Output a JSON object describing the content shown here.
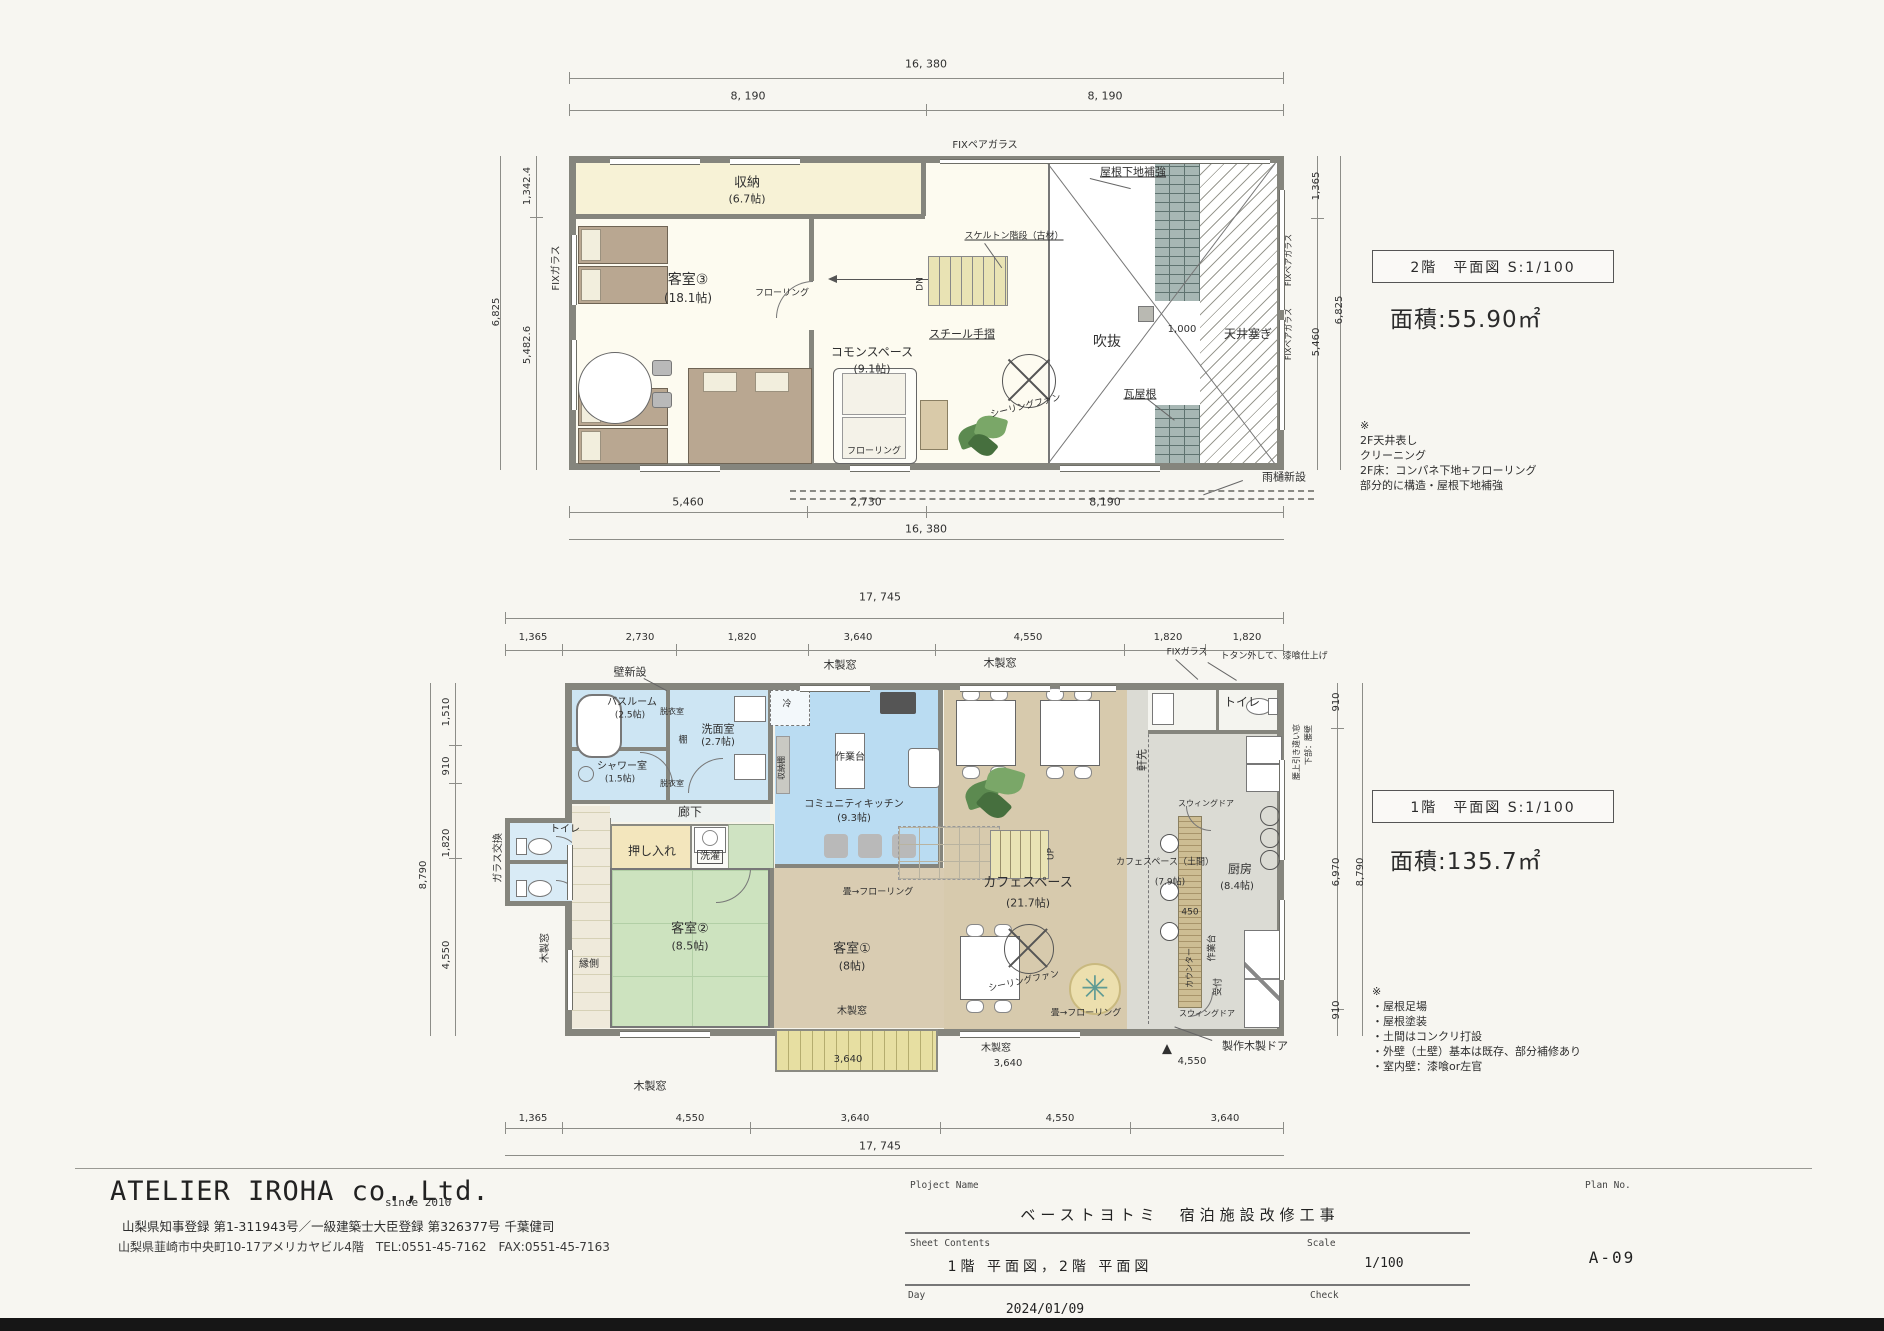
{
  "company": {
    "name": "ATELIER IROHA co.,Ltd.",
    "since": "since 2010",
    "registration": "山梨県知事登録 第1-311943号／一級建築士大臣登録 第326377号 千葉健司",
    "address": "山梨県韮崎市中央町10-17アメリカヤビル4階　TEL:0551-45-7162　FAX:0551-45-7163"
  },
  "titleblock": {
    "project_label": "Ploject Name",
    "project_name": "ベーストヨトミ　宿泊施設改修工事",
    "sheet_label": "Sheet Contents",
    "sheet_contents": "1階 平面図，2階 平面図",
    "scale_label": "Scale",
    "scale": "1/100",
    "day_label": "Day",
    "day": "2024/01/09",
    "check_label": "Check",
    "plan_no_label": "Plan No.",
    "plan_no": "A-09"
  },
  "floor2": {
    "title": "2階　平面図 S:1/100",
    "area": "面積:55.90㎡",
    "notes": [
      "※",
      "2F天井表し",
      "クリーニング",
      "2F床：コンパネ下地+フローリング",
      "部分的に構造・屋根下地補強"
    ],
    "labels": [
      {
        "t": "16, 380",
        "x": 926,
        "y": 64,
        "fs": 11,
        "n": "dim-overall-width-2f"
      },
      {
        "t": "8, 190",
        "x": 748,
        "y": 96,
        "fs": 11,
        "n": "dim"
      },
      {
        "t": "8, 190",
        "x": 1105,
        "y": 96,
        "fs": 11,
        "n": "dim"
      },
      {
        "t": "FIXペアガラス",
        "x": 985,
        "y": 146,
        "fs": 10,
        "n": "fix-pair-glass-label"
      },
      {
        "t": "1,342.4",
        "x": 528,
        "y": 186,
        "fs": 10,
        "r": -90,
        "n": "dim"
      },
      {
        "t": "5,482.6",
        "x": 528,
        "y": 345,
        "fs": 10,
        "r": -90,
        "n": "dim"
      },
      {
        "t": "6,825",
        "x": 497,
        "y": 312,
        "fs": 10,
        "r": -90,
        "n": "dim"
      },
      {
        "t": "FIXガラス",
        "x": 557,
        "y": 268,
        "fs": 10,
        "r": -90,
        "n": "fix-glass-label"
      },
      {
        "t": "収納",
        "x": 747,
        "y": 183,
        "fs": 13,
        "n": "room-label-storage"
      },
      {
        "t": "(6.7帖)",
        "x": 747,
        "y": 199,
        "fs": 11,
        "n": "room-size"
      },
      {
        "t": "客室③",
        "x": 688,
        "y": 280,
        "fs": 14,
        "n": "room-label-guestroom3"
      },
      {
        "t": "(18.1帖)",
        "x": 688,
        "y": 298,
        "fs": 12,
        "n": "room-size"
      },
      {
        "t": "フローリング",
        "x": 782,
        "y": 294,
        "fs": 9,
        "n": "flooring-note"
      },
      {
        "t": "コモンスペース",
        "x": 872,
        "y": 352,
        "fs": 12,
        "n": "room-label-common-space"
      },
      {
        "t": "(9.1帖)",
        "x": 872,
        "y": 369,
        "fs": 11,
        "n": "room-size"
      },
      {
        "t": "フローリング",
        "x": 874,
        "y": 452,
        "fs": 9,
        "n": "flooring-note"
      },
      {
        "t": "スケルトン階段（古材）",
        "x": 1014,
        "y": 237,
        "fs": 9,
        "ul": true,
        "n": "stair-note"
      },
      {
        "t": "DN",
        "x": 921,
        "y": 284,
        "fs": 9,
        "r": -90,
        "n": "stair-down-label"
      },
      {
        "t": "スチール手摺",
        "x": 962,
        "y": 334,
        "fs": 11,
        "ul": true,
        "n": "steel-handrail-label"
      },
      {
        "t": "吹抜",
        "x": 1107,
        "y": 342,
        "fs": 14,
        "n": "void-label"
      },
      {
        "t": "シーリングファン",
        "x": 1026,
        "y": 407,
        "fs": 9,
        "r": -14,
        "n": "ceiling-fan-label"
      },
      {
        "t": "瓦屋根",
        "x": 1140,
        "y": 394,
        "fs": 11,
        "ul": true,
        "n": "tile-roof-label"
      },
      {
        "t": "屋根下地補強",
        "x": 1133,
        "y": 172,
        "fs": 11,
        "ul": true,
        "n": "roof-reinforce-label"
      },
      {
        "t": "1,000",
        "x": 1182,
        "y": 330,
        "fs": 10,
        "n": "dim"
      },
      {
        "t": "天井塞ぎ",
        "x": 1248,
        "y": 334,
        "fs": 12,
        "n": "ceiling-close-label"
      },
      {
        "t": "FIXペアガラス",
        "x": 1289,
        "y": 260,
        "fs": 8,
        "r": -90,
        "n": "fix-pair-glass-label"
      },
      {
        "t": "FIXペアガラス",
        "x": 1289,
        "y": 334,
        "fs": 8,
        "r": -90,
        "n": "fix-pair-glass-label"
      },
      {
        "t": "1,365",
        "x": 1317,
        "y": 186,
        "fs": 10,
        "r": -90,
        "n": "dim"
      },
      {
        "t": "5,460",
        "x": 1317,
        "y": 342,
        "fs": 10,
        "r": -90,
        "n": "dim"
      },
      {
        "t": "6,825",
        "x": 1340,
        "y": 310,
        "fs": 10,
        "r": -90,
        "n": "dim"
      },
      {
        "t": "5,460",
        "x": 688,
        "y": 502,
        "fs": 11,
        "n": "dim"
      },
      {
        "t": "2,730",
        "x": 866,
        "y": 502,
        "fs": 11,
        "n": "dim"
      },
      {
        "t": "8,190",
        "x": 1105,
        "y": 502,
        "fs": 11,
        "n": "dim"
      },
      {
        "t": "16, 380",
        "x": 926,
        "y": 529,
        "fs": 11,
        "n": "dim"
      },
      {
        "t": "雨樋新設",
        "x": 1284,
        "y": 477,
        "fs": 11,
        "n": "rain-gutter-label"
      }
    ]
  },
  "floor1": {
    "title": "1階　平面図 S:1/100",
    "area": "面積:135.7㎡",
    "notes": [
      "※",
      "・屋根足場",
      "・屋根塗装",
      "・土間はコンクリ打設",
      "・外壁（土壁）基本は既存、部分補修あり",
      "・室内壁：漆喰or左官"
    ],
    "labels": [
      {
        "t": "17, 745",
        "x": 880,
        "y": 597,
        "fs": 11,
        "n": "dim-overall-width-1f"
      },
      {
        "t": "1,365",
        "x": 533,
        "y": 638,
        "fs": 10,
        "n": "dim"
      },
      {
        "t": "2,730",
        "x": 640,
        "y": 638,
        "fs": 10,
        "n": "dim"
      },
      {
        "t": "1,820",
        "x": 742,
        "y": 638,
        "fs": 10,
        "n": "dim"
      },
      {
        "t": "3,640",
        "x": 858,
        "y": 638,
        "fs": 10,
        "n": "dim"
      },
      {
        "t": "4,550",
        "x": 1028,
        "y": 638,
        "fs": 10,
        "n": "dim"
      },
      {
        "t": "1,820",
        "x": 1168,
        "y": 638,
        "fs": 10,
        "n": "dim"
      },
      {
        "t": "1,820",
        "x": 1247,
        "y": 638,
        "fs": 10,
        "n": "dim"
      },
      {
        "t": "壁新設",
        "x": 630,
        "y": 672,
        "fs": 11,
        "n": "new-wall-label"
      },
      {
        "t": "木製窓",
        "x": 840,
        "y": 665,
        "fs": 11,
        "n": "wood-window-label"
      },
      {
        "t": "木製窓",
        "x": 1000,
        "y": 663,
        "fs": 11,
        "n": "wood-window-label"
      },
      {
        "t": "FIXガラス",
        "x": 1187,
        "y": 653,
        "fs": 9,
        "n": "fix-glass-label"
      },
      {
        "t": "トタン外して、漆喰仕上げ",
        "x": 1274,
        "y": 657,
        "fs": 9,
        "n": "plaster-finish-note"
      },
      {
        "t": "トイレ",
        "x": 1242,
        "y": 702,
        "fs": 12,
        "n": "room-label-toilet"
      },
      {
        "t": "バスルーム",
        "x": 632,
        "y": 703,
        "fs": 10,
        "n": "room-label-bathroom"
      },
      {
        "t": "(2.5帖)",
        "x": 630,
        "y": 716,
        "fs": 9,
        "n": "room-size"
      },
      {
        "t": "脱衣室",
        "x": 672,
        "y": 712,
        "fs": 8,
        "n": "room-label-dressing"
      },
      {
        "t": "洗面室",
        "x": 718,
        "y": 729,
        "fs": 11,
        "n": "room-label-washroom"
      },
      {
        "t": "(2.7帖)",
        "x": 718,
        "y": 743,
        "fs": 10,
        "n": "room-size"
      },
      {
        "t": "棚",
        "x": 683,
        "y": 741,
        "fs": 9,
        "n": "shelf-label"
      },
      {
        "t": "シャワー室",
        "x": 622,
        "y": 767,
        "fs": 10,
        "n": "room-label-shower"
      },
      {
        "t": "(1.5帖)",
        "x": 620,
        "y": 780,
        "fs": 9,
        "n": "room-size"
      },
      {
        "t": "脱衣室",
        "x": 672,
        "y": 784,
        "fs": 8,
        "n": "room-label-dressing"
      },
      {
        "t": "冷",
        "x": 787,
        "y": 705,
        "fs": 9,
        "n": "fridge-label"
      },
      {
        "t": "作業台",
        "x": 850,
        "y": 758,
        "fs": 10,
        "n": "worktable-label"
      },
      {
        "t": "コミュニティキッチン",
        "x": 854,
        "y": 805,
        "fs": 10,
        "n": "room-label-community-kitchen"
      },
      {
        "t": "(9.3帖)",
        "x": 854,
        "y": 819,
        "fs": 10,
        "n": "room-size"
      },
      {
        "t": "収納棚",
        "x": 782,
        "y": 768,
        "fs": 8,
        "r": -90,
        "n": "storage-shelf-label"
      },
      {
        "t": "廊下",
        "x": 690,
        "y": 812,
        "fs": 12,
        "n": "room-label-corridor"
      },
      {
        "t": "ガラス交換",
        "x": 499,
        "y": 858,
        "fs": 10,
        "r": -90,
        "n": "glass-replace-label"
      },
      {
        "t": "トイレ",
        "x": 565,
        "y": 830,
        "fs": 10,
        "n": "room-label-toilet"
      },
      {
        "t": "押し入れ",
        "x": 652,
        "y": 851,
        "fs": 12,
        "n": "room-label-closet"
      },
      {
        "t": "洗濯",
        "x": 710,
        "y": 857,
        "fs": 10,
        "box": true,
        "n": "laundry-label"
      },
      {
        "t": "客室②",
        "x": 690,
        "y": 929,
        "fs": 13,
        "n": "room-label-guestroom2"
      },
      {
        "t": "(8.5帖)",
        "x": 690,
        "y": 946,
        "fs": 11,
        "n": "room-size"
      },
      {
        "t": "縁側",
        "x": 589,
        "y": 965,
        "fs": 10,
        "n": "room-label-engawa"
      },
      {
        "t": "木製窓",
        "x": 546,
        "y": 948,
        "fs": 10,
        "r": -90,
        "n": "wood-window-label"
      },
      {
        "t": "客室①",
        "x": 852,
        "y": 949,
        "fs": 13,
        "n": "room-label-guestroom1"
      },
      {
        "t": "(8帖)",
        "x": 852,
        "y": 966,
        "fs": 11,
        "n": "room-size"
      },
      {
        "t": "畳→フローリング",
        "x": 878,
        "y": 893,
        "fs": 9,
        "n": "tatami-to-flooring-note"
      },
      {
        "t": "木製窓",
        "x": 852,
        "y": 1012,
        "fs": 10,
        "n": "wood-window-label"
      },
      {
        "t": "カフェスペース",
        "x": 1028,
        "y": 883,
        "fs": 13,
        "n": "room-label-cafe-space"
      },
      {
        "t": "(21.7帖)",
        "x": 1028,
        "y": 903,
        "fs": 11,
        "n": "room-size"
      },
      {
        "t": "シーリングファン",
        "x": 1024,
        "y": 982,
        "fs": 9,
        "r": -12,
        "n": "ceiling-fan-label"
      },
      {
        "t": "畳→フローリング",
        "x": 1086,
        "y": 1014,
        "fs": 9,
        "n": "tatami-to-flooring-note"
      },
      {
        "t": "UP",
        "x": 1052,
        "y": 854,
        "fs": 9,
        "r": -90,
        "n": "stair-up-label"
      },
      {
        "t": "軒先",
        "x": 1142,
        "y": 760,
        "fs": 11,
        "r": -90,
        "n": "eave-label"
      },
      {
        "t": "カフェスペース（土間）",
        "x": 1165,
        "y": 863,
        "fs": 9,
        "n": "room-label-cafe-doma"
      },
      {
        "t": "(7.9帖)",
        "x": 1170,
        "y": 883,
        "fs": 9,
        "n": "room-size"
      },
      {
        "t": "450",
        "x": 1190,
        "y": 913,
        "fs": 9,
        "n": "dim"
      },
      {
        "t": "カウンター",
        "x": 1190,
        "y": 968,
        "fs": 8,
        "r": -90,
        "n": "counter-label"
      },
      {
        "t": "作業台",
        "x": 1213,
        "y": 948,
        "fs": 9,
        "r": -90,
        "n": "worktable-label"
      },
      {
        "t": "受付",
        "x": 1219,
        "y": 987,
        "fs": 9,
        "r": -90,
        "n": "reception-label"
      },
      {
        "t": "スウィングドア",
        "x": 1206,
        "y": 804,
        "fs": 8,
        "n": "swing-door-label"
      },
      {
        "t": "スウィングドア",
        "x": 1207,
        "y": 1014,
        "fs": 8,
        "n": "swing-door-label"
      },
      {
        "t": "厨房",
        "x": 1240,
        "y": 869,
        "fs": 12,
        "n": "room-label-kitchen"
      },
      {
        "t": "(8.4帖)",
        "x": 1237,
        "y": 887,
        "fs": 10,
        "n": "room-size"
      },
      {
        "t": "腰上引き違い窓",
        "x": 1297,
        "y": 752,
        "fs": 8,
        "r": -90,
        "n": "window-note"
      },
      {
        "t": "下部：腰壁",
        "x": 1309,
        "y": 745,
        "fs": 8,
        "r": -90,
        "n": "window-note"
      },
      {
        "t": "910",
        "x": 1337,
        "y": 702,
        "fs": 10,
        "r": -90,
        "n": "dim"
      },
      {
        "t": "6,970",
        "x": 1337,
        "y": 872,
        "fs": 10,
        "r": -90,
        "n": "dim"
      },
      {
        "t": "910",
        "x": 1337,
        "y": 1010,
        "fs": 10,
        "r": -90,
        "n": "dim"
      },
      {
        "t": "8,790",
        "x": 1361,
        "y": 872,
        "fs": 10,
        "r": -90,
        "n": "dim"
      },
      {
        "t": "1,510",
        "x": 447,
        "y": 712,
        "fs": 10,
        "r": -90,
        "n": "dim"
      },
      {
        "t": "910",
        "x": 447,
        "y": 766,
        "fs": 10,
        "r": -90,
        "n": "dim"
      },
      {
        "t": "1,820",
        "x": 447,
        "y": 843,
        "fs": 10,
        "r": -90,
        "n": "dim"
      },
      {
        "t": "4,550",
        "x": 447,
        "y": 955,
        "fs": 10,
        "r": -90,
        "n": "dim"
      },
      {
        "t": "8,790",
        "x": 424,
        "y": 875,
        "fs": 10,
        "r": -90,
        "n": "dim"
      },
      {
        "t": "木製窓",
        "x": 650,
        "y": 1086,
        "fs": 11,
        "n": "wood-window-label"
      },
      {
        "t": "3,640",
        "x": 848,
        "y": 1060,
        "fs": 10,
        "n": "dim"
      },
      {
        "t": "木製窓",
        "x": 996,
        "y": 1049,
        "fs": 10,
        "n": "wood-window-label"
      },
      {
        "t": "3,640",
        "x": 1008,
        "y": 1064,
        "fs": 10,
        "n": "dim"
      },
      {
        "t": "▲",
        "x": 1167,
        "y": 1049,
        "fs": 13,
        "n": "entrance-marker"
      },
      {
        "t": "4,550",
        "x": 1192,
        "y": 1062,
        "fs": 10,
        "n": "dim"
      },
      {
        "t": "製作木製ドア",
        "x": 1255,
        "y": 1046,
        "fs": 11,
        "n": "custom-wood-door-label"
      },
      {
        "t": "1,365",
        "x": 533,
        "y": 1119,
        "fs": 10,
        "n": "dim"
      },
      {
        "t": "4,550",
        "x": 690,
        "y": 1119,
        "fs": 10,
        "n": "dim"
      },
      {
        "t": "3,640",
        "x": 855,
        "y": 1119,
        "fs": 10,
        "n": "dim"
      },
      {
        "t": "4,550",
        "x": 1060,
        "y": 1119,
        "fs": 10,
        "n": "dim"
      },
      {
        "t": "3,640",
        "x": 1225,
        "y": 1119,
        "fs": 10,
        "n": "dim"
      },
      {
        "t": "17, 745",
        "x": 880,
        "y": 1146,
        "fs": 11,
        "n": "dim"
      }
    ]
  }
}
